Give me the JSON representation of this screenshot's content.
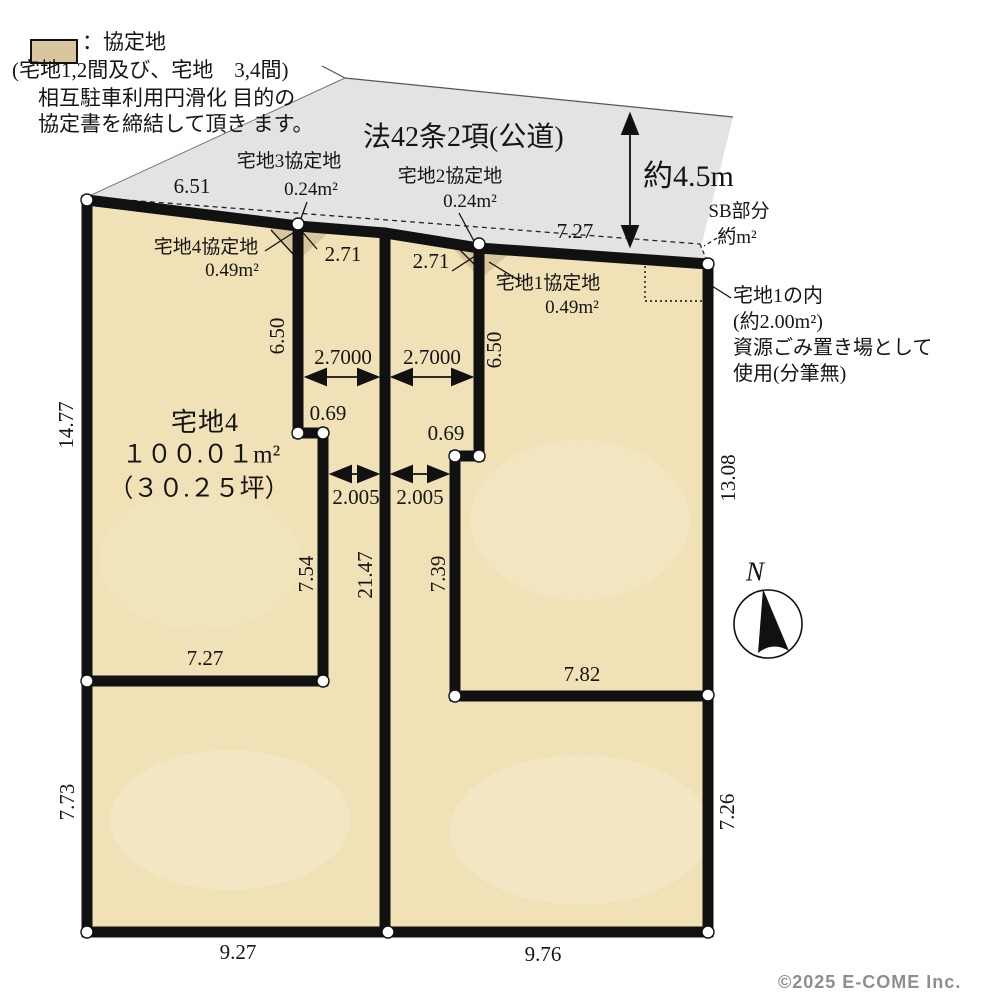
{
  "title": "区画図",
  "colors": {
    "plot_fill": "#f0e1b6",
    "agreement_fill": "#d8c79e",
    "road_fill": "#e3e3e3",
    "outline": "#111111",
    "marker_fill": "#ffffff",
    "copyright_gray": "#8e8e8e"
  },
  "legend": {
    "title": "：協定地",
    "line2": "(宅地1,2間及び、宅地　3,4間)",
    "line3": "相互駐車利用円滑化 目的の",
    "line4": "協定書を締結して頂き ます。"
  },
  "road": {
    "label": "法42条2項(公道)",
    "width": "約4.5m"
  },
  "setback": {
    "label": "SB部分",
    "area": "約m²"
  },
  "plot1_note": {
    "line1": "宅地1の内",
    "line2": "(約2.00m²)",
    "line3": "資源ごみ置き場として",
    "line4": "使用(分筆無)"
  },
  "agreement_areas": {
    "plot3": {
      "label": "宅地3協定地",
      "area": "0.24m²"
    },
    "plot2": {
      "label": "宅地2協定地",
      "area": "0.24m²"
    },
    "plot4": {
      "label": "宅地4協定地",
      "area": "0.49m²"
    },
    "plot1": {
      "label": "宅地1協定地",
      "area": "0.49m²"
    }
  },
  "plot4": {
    "name": "宅地4",
    "area": "１００.０１m²",
    "tsubo": "（３０.２５坪）"
  },
  "dimensions": {
    "top_left": "6.51",
    "top_right": "7.27",
    "west_upper": "14.77",
    "west_lower": "7.73",
    "east_upper": "13.08",
    "east_lower": "7.26",
    "south_left": "9.27",
    "south_right": "9.76",
    "corridor_left_top": "2.71",
    "corridor_right_top": "2.71",
    "wall_left_upper": "6.50",
    "wall_right_upper": "6.50",
    "corridor_left_width_top": "2.7000",
    "corridor_right_width_top": "2.7000",
    "jog_left": "0.69",
    "jog_right": "0.69",
    "corridor_left_width_bottom": "2.005",
    "corridor_right_width_bottom": "2.005",
    "plot4_east_lower": "7.54",
    "center_wall": "21.47",
    "plot1_west_lower": "7.39",
    "plot4_south": "7.27",
    "plot1_south": "7.82"
  },
  "compass": {
    "label": "N"
  },
  "footer": {
    "copyright": "©2025  E-COME Inc."
  }
}
